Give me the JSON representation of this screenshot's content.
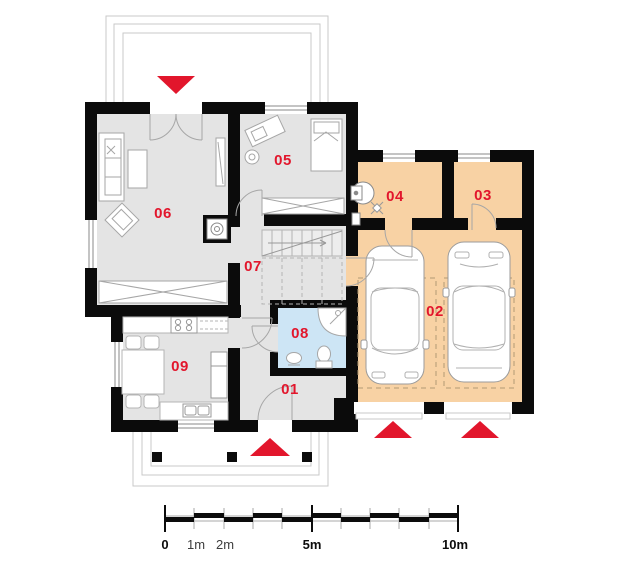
{
  "page": {
    "type": "architectural-floor-plan",
    "view": "ground-floor"
  },
  "rooms": [
    {
      "number": "01"
    },
    {
      "number": "02"
    },
    {
      "number": "03"
    },
    {
      "number": "04"
    },
    {
      "number": "05"
    },
    {
      "number": "06"
    },
    {
      "number": "07"
    },
    {
      "number": "08"
    },
    {
      "number": "09"
    }
  ],
  "scalebar": {
    "labels": [
      "0",
      "1m",
      "2m",
      "5m",
      "10m"
    ]
  },
  "colors": {
    "label_red": "#e2162c",
    "arrow_red": "#e2162c",
    "wall_black": "#0b0b0b",
    "room_gray": "#e4e4e4",
    "garage_orange": "#f8d2a4",
    "bath_blue": "#cde5f5",
    "furniture_gray": "#a6a6a6",
    "outline_gray": "#c9c9c9"
  }
}
